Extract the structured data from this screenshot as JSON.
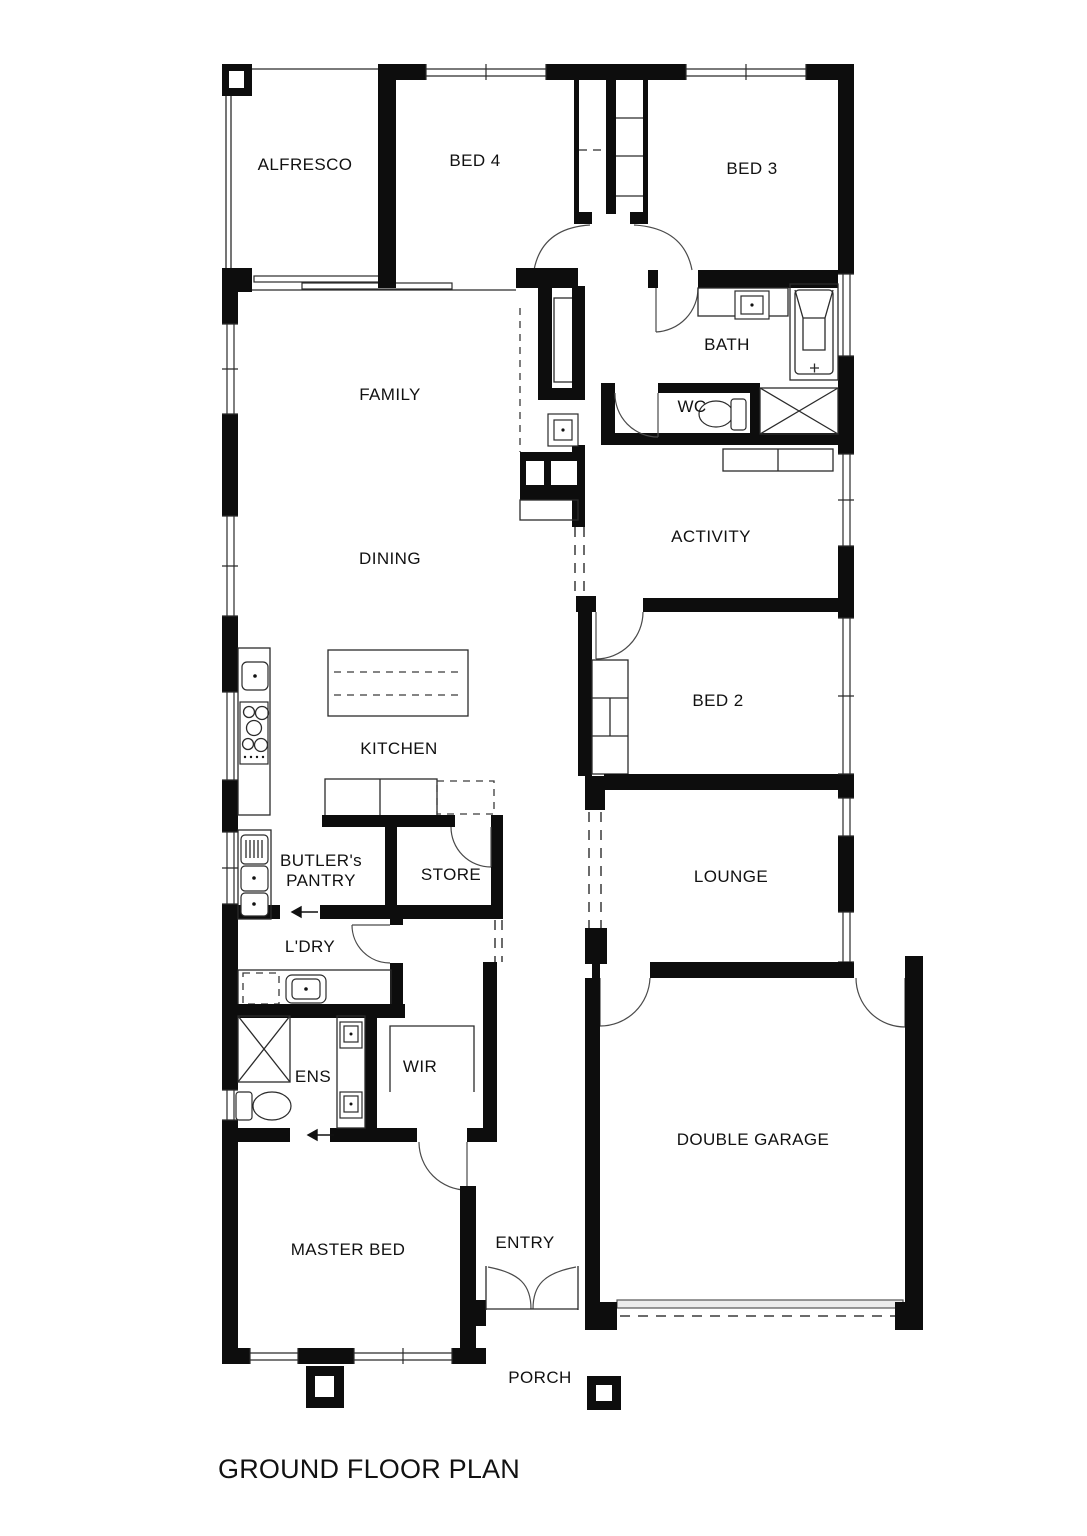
{
  "plan": {
    "title": "GROUND FLOOR PLAN",
    "rooms": {
      "alfresco": "ALFRESCO",
      "bed4": "BED 4",
      "bed3": "BED 3",
      "family": "FAMILY",
      "bath": "BATH",
      "wc": "WC",
      "activity": "ACTIVITY",
      "dining": "DINING",
      "bed2": "BED 2",
      "kitchen": "KITCHEN",
      "butlers_pantry_line1": "BUTLER's",
      "butlers_pantry_line2": "PANTRY",
      "store": "STORE",
      "lounge": "LOUNGE",
      "laundry": "L'DRY",
      "ensuite": "ENS",
      "wir": "WIR",
      "garage": "DOUBLE GARAGE",
      "master_bed": "MASTER BED",
      "entry": "ENTRY",
      "porch": "PORCH"
    },
    "fixtures": [
      "bathtub",
      "shower",
      "toilet",
      "vanity-basin",
      "double-vanity",
      "kitchen-island",
      "cooktop",
      "kitchen-sink",
      "butlers-pantry-sinks",
      "dishwasher",
      "laundry-sink",
      "washing-machine-space",
      "fridge-space",
      "wardrobe-robes",
      "linen-cupboard",
      "entry-double-door",
      "garage-panel-door",
      "porch-post"
    ],
    "colors": {
      "ink": "#0d0d0d",
      "paper": "#ffffff",
      "thin_line": "#2b2b2b"
    }
  }
}
